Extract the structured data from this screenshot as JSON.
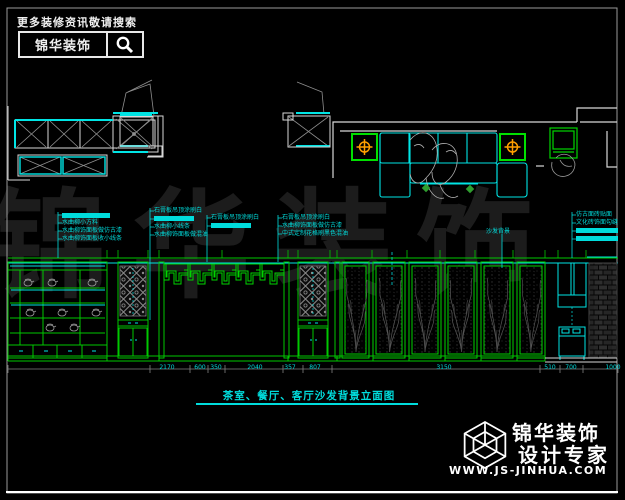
{
  "colors": {
    "background": "#000000",
    "line_green": "#00c800",
    "line_cyan": "#00e5e5",
    "line_white": "#e0e0e0",
    "annotation_cyan": "#00dcdc",
    "downlight_orange": "#ffa000",
    "watermark_gray": "#1c1c1c"
  },
  "header": {
    "search_hint": "更多装修资讯敬请搜索",
    "brand": "锦华装饰",
    "search_icon": "magnifier"
  },
  "watermark": {
    "text": "锦华装饰"
  },
  "callouts": {
    "groups": [
      {
        "lines": [
          {
            "text": "",
            "highlight": true
          },
          {
            "text": "水曲柳小方料",
            "highlight": false
          },
          {
            "text": "水曲柳饰面板做仿古漆",
            "highlight": false
          },
          {
            "text": "水曲柳饰面板收小线条",
            "highlight": false
          }
        ]
      },
      {
        "lines": [
          {
            "text": "石膏板吊顶涂刷白",
            "highlight": false
          },
          {
            "text": "",
            "highlight": true
          },
          {
            "text": "水曲柳小线条",
            "highlight": false
          },
          {
            "text": "水曲柳饰面板做混油",
            "highlight": false
          }
        ]
      },
      {
        "lines": [
          {
            "text": "石膏板吊顶涂刷白",
            "highlight": false
          },
          {
            "text": "",
            "highlight": true
          }
        ]
      },
      {
        "lines": [
          {
            "text": "石膏板吊顶涂刷白",
            "highlight": false
          },
          {
            "text": "水曲柳饰面板做仿古漆",
            "highlight": false
          },
          {
            "text": "中式定制花格刷黑色混油",
            "highlight": false
          }
        ]
      },
      {
        "lines": [
          {
            "text": "仿古面砖贴面",
            "highlight": false
          },
          {
            "text": "文化砖饰面勾缝",
            "highlight": false
          },
          {
            "text": "",
            "highlight": true
          },
          {
            "text": "",
            "highlight": true
          }
        ]
      }
    ],
    "sofa_label": "沙发背景"
  },
  "dims": {
    "values": [
      "2170",
      "600",
      "350",
      "2040",
      "357",
      "807",
      "3150",
      "510",
      "700",
      "1000"
    ]
  },
  "title": {
    "text": "茶室、餐厅、客厅沙发背景立面图"
  },
  "footer": {
    "brand": "锦华装饰",
    "tagline": "设计专家",
    "website": "WWW.JS-JINHUA.COM",
    "logo_icon": "wireframe-cube"
  }
}
